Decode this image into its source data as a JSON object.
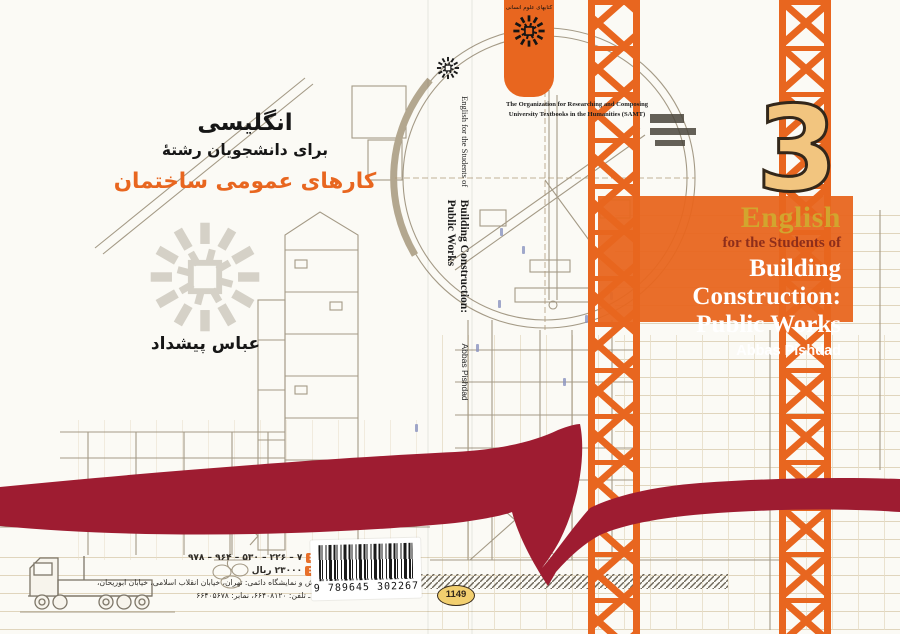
{
  "publisher": {
    "fa_logo_text": "کتابهای علوم انسانی",
    "org_line1": "The Organization for Researching and Composing",
    "org_line2": "University Textbooks in the Humanities (SAMT)"
  },
  "front": {
    "volume_number": "3",
    "series_badge": "1149",
    "title_lead": "English",
    "title_sub": "for the Students of",
    "title_line1": "Building Construction:",
    "title_line2": "Public Works",
    "author": "Abbas Pishdad"
  },
  "spine": {
    "lead": "English for the Students of",
    "title_line1": "Building Construction:",
    "title_line2": "Public Works",
    "author": "Abbas Pishdad"
  },
  "back": {
    "fa_subject_line1": "انگلیسی",
    "fa_subject_line2": "برای دانشجویان رشتهٔ",
    "fa_subject_line3": "کارهای عمومی ساختمان",
    "fa_author": "عباس پیشداد",
    "isbn_label": "شابک:",
    "isbn_value": "۹۷۸ – ۹۶۴ – ۵۳۰ – ۲۲۶ – ۷",
    "price_label": "قیمت:",
    "price_value": "۲۳۰۰۰ ریال",
    "address_line1": "مرکز پخش و نمایشگاه دائمی: تهران، خیابان انقلاب اسلامی، خیابان ابوریحان،",
    "address_line2": "شماره ۲ ـ تلفن: ۶۶۴۰۸۱۲۰، نمابر: ۶۶۴۰۵۶۷۸"
  },
  "barcode": {
    "number": "9 789645 302267"
  },
  "colors": {
    "accent_orange": "#e8661f",
    "ribbon_red": "#9e1c31",
    "number_fill": "#f2c57f",
    "title_gold": "#d2a52e",
    "subtitle_maroon": "#8e2e1a"
  }
}
